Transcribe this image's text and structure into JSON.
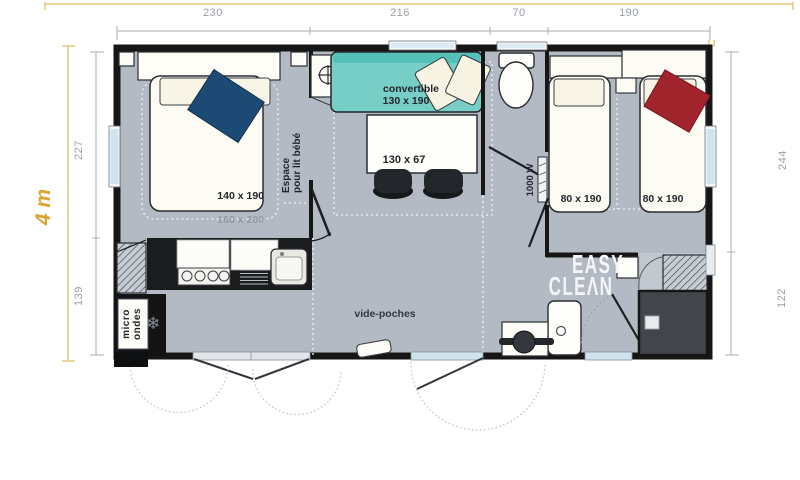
{
  "dims": {
    "top": [
      "230",
      "216",
      "70",
      "190"
    ],
    "left": [
      "227",
      "139"
    ],
    "right": [
      "244",
      "122"
    ],
    "overall_width": "4 m"
  },
  "master_bedroom": {
    "bed_size": "140 x 190",
    "bed_outer_size": "160 x 200",
    "baby_space_line1": "Espace",
    "baby_space_line2": "pour lit bébé"
  },
  "living": {
    "sofa_label": "convertible",
    "sofa_size": "130 x 190",
    "table_size": "130 x 67"
  },
  "twin_bedroom": {
    "bed_left_size": "80 x 190",
    "bed_right_size": "80 x 190",
    "heater_power": "1000 W"
  },
  "kitchen": {
    "microwave_line1": "micro",
    "microwave_line2": "ondes",
    "freezer_icon": "❄"
  },
  "entrance": {
    "shelf_label": "vide-poches"
  },
  "bathroom": {
    "logo_line1": "EASY",
    "logo_line2": "CLEΛN"
  },
  "colors": {
    "floor": "#b4bac4",
    "wall": "#161616",
    "sofa_teal": "#76cec7",
    "pillow_blue": "#1c4a74",
    "pillow_red": "#a1242d",
    "accent_yellow": "#d9a52f",
    "window_blue": "#cfe4ee",
    "counter_black": "#1b1c1e",
    "dark_room": "#42464c",
    "dim_text": "#989ea6"
  }
}
